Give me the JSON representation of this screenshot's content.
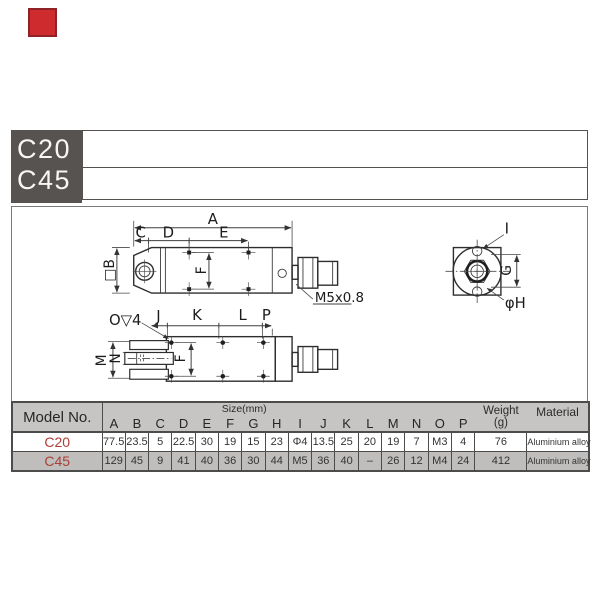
{
  "colors": {
    "marker_red": "#ce2b2f",
    "header_block_bg": "#575350",
    "table_header_bg": "#c7c5c3",
    "row_alt_bg": "#c0bebc",
    "model_red": "#ab3e38",
    "grid_border": "#4c4c4c"
  },
  "header": {
    "models": [
      "C20",
      "C45"
    ]
  },
  "drawing": {
    "top_view_labels": {
      "A": "A",
      "C": "C",
      "D": "D",
      "E": "E",
      "F": "F",
      "B": "□B",
      "thread": "M5x0.8"
    },
    "end_view_labels": {
      "I": "I",
      "G": "G",
      "H": "φH"
    },
    "bottom_view_labels": {
      "counterbore": "O▽4",
      "J": "J",
      "K": "K",
      "L": "L",
      "P": "P",
      "F": "F",
      "M": "M",
      "N": "N"
    }
  },
  "table": {
    "model_header": "Model No.",
    "size_header": "Size(mm)",
    "weight_header": "Weight",
    "weight_unit": "(g)",
    "material_header": "Material",
    "columns": [
      "A",
      "B",
      "C",
      "D",
      "E",
      "F",
      "G",
      "H",
      "I",
      "J",
      "K",
      "L",
      "M",
      "N",
      "O",
      "P"
    ],
    "rows": [
      {
        "model": "C20",
        "values": [
          "77.5",
          "23.5",
          "5",
          "22.5",
          "30",
          "19",
          "15",
          "23",
          "Φ4",
          "13.5",
          "25",
          "20",
          "19",
          "7",
          "M3",
          "4"
        ],
        "weight": "76",
        "material": "Aluminium alloy"
      },
      {
        "model": "C45",
        "values": [
          "129",
          "45",
          "9",
          "41",
          "40",
          "36",
          "30",
          "44",
          "M5",
          "36",
          "40",
          "–",
          "26",
          "12",
          "M4",
          "24"
        ],
        "weight": "412",
        "material": "Aluminium alloy"
      }
    ]
  }
}
